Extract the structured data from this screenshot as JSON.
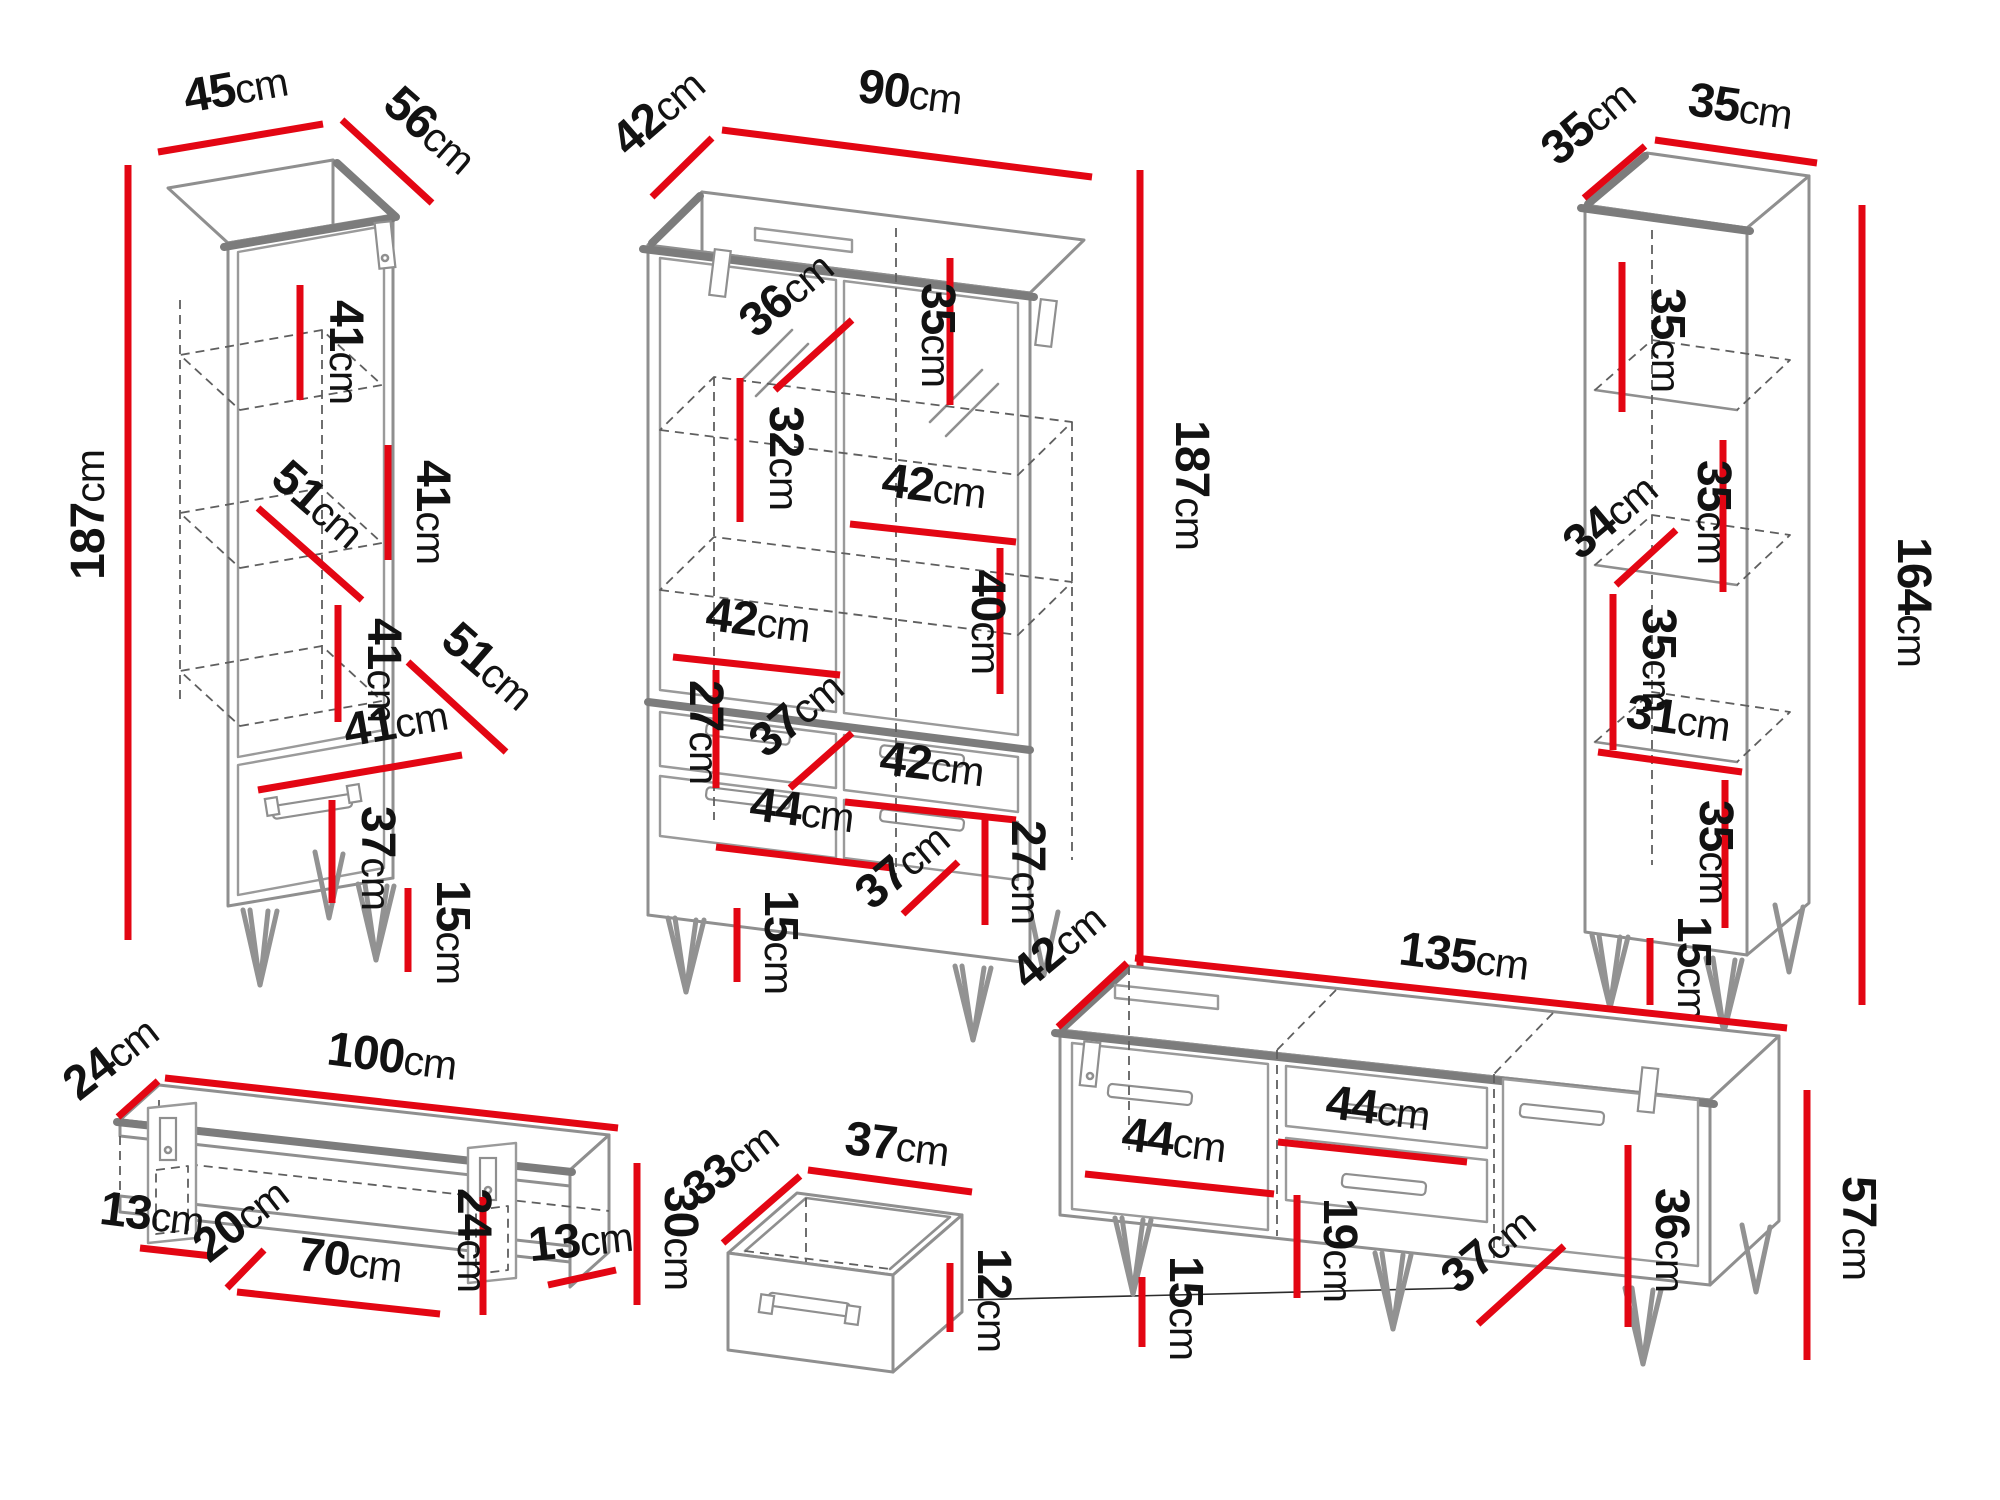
{
  "diagram_title": "Furniture set dimension diagram",
  "colors": {
    "dimension_line": "#e30613",
    "outline": "#8f8f8f",
    "label_text": "#121212",
    "background": "#ffffff"
  },
  "pieces": {
    "tall_cabinet": {
      "dims": {
        "width": {
          "v": "45",
          "u": "cm"
        },
        "depth": {
          "v": "56",
          "u": "cm"
        },
        "height": {
          "v": "187",
          "u": "cm"
        },
        "comp1": {
          "v": "41",
          "u": "cm"
        },
        "comp2": {
          "v": "41",
          "u": "cm"
        },
        "shelf_diag1": {
          "v": "51",
          "u": "cm"
        },
        "comp3": {
          "v": "41",
          "u": "cm"
        },
        "shelf_diag2": {
          "v": "51",
          "u": "cm"
        },
        "inner_width": {
          "v": "41",
          "u": "cm"
        },
        "drawer": {
          "v": "37",
          "u": "cm"
        },
        "legs": {
          "v": "15",
          "u": "cm"
        }
      }
    },
    "display_cabinet": {
      "dims": {
        "depth": {
          "v": "42",
          "u": "cm"
        },
        "width": {
          "v": "90",
          "u": "cm"
        },
        "height": {
          "v": "187",
          "u": "cm"
        },
        "glass_shelf": {
          "v": "36",
          "u": "cm"
        },
        "shelf_right": {
          "v": "35",
          "u": "cm"
        },
        "shelf_left": {
          "v": "32",
          "u": "cm"
        },
        "inner_right": {
          "v": "42",
          "u": "cm"
        },
        "door_height": {
          "v": "40",
          "u": "cm"
        },
        "inner_left": {
          "v": "42",
          "u": "cm"
        },
        "drawer_left": {
          "v": "27",
          "u": "cm"
        },
        "drawer_front": {
          "v": "37",
          "u": "cm"
        },
        "inner_lower": {
          "v": "42",
          "u": "cm"
        },
        "bottom_width": {
          "v": "44",
          "u": "cm"
        },
        "bottom_drawer": {
          "v": "37",
          "u": "cm"
        },
        "drawer_right": {
          "v": "27",
          "u": "cm"
        },
        "legs": {
          "v": "15",
          "u": "cm"
        }
      }
    },
    "shelf_unit": {
      "dims": {
        "depth": {
          "v": "35",
          "u": "cm"
        },
        "width": {
          "v": "35",
          "u": "cm"
        },
        "height": {
          "v": "164",
          "u": "cm"
        },
        "comp1": {
          "v": "35",
          "u": "cm"
        },
        "shelf_diag": {
          "v": "34",
          "u": "cm"
        },
        "comp2": {
          "v": "35",
          "u": "cm"
        },
        "comp3": {
          "v": "35",
          "u": "cm"
        },
        "inner_width": {
          "v": "31",
          "u": "cm"
        },
        "comp4": {
          "v": "35",
          "u": "cm"
        },
        "legs": {
          "v": "15",
          "u": "cm"
        }
      }
    },
    "wall_shelf": {
      "dims": {
        "depth": {
          "v": "24",
          "u": "cm"
        },
        "width": {
          "v": "100",
          "u": "cm"
        },
        "end_left": {
          "v": "13",
          "u": "cm"
        },
        "inner_depth": {
          "v": "20",
          "u": "cm"
        },
        "inner_width": {
          "v": "70",
          "u": "cm"
        },
        "inner_height": {
          "v": "24",
          "u": "cm"
        },
        "end_right": {
          "v": "13",
          "u": "cm"
        },
        "height": {
          "v": "30",
          "u": "cm"
        }
      }
    },
    "drawer_box": {
      "dims": {
        "depth": {
          "v": "33",
          "u": "cm"
        },
        "width": {
          "v": "37",
          "u": "cm"
        },
        "height": {
          "v": "12",
          "u": "cm"
        }
      }
    },
    "tv_stand": {
      "dims": {
        "depth": {
          "v": "42",
          "u": "cm"
        },
        "width": {
          "v": "135",
          "u": "cm"
        },
        "door_left": {
          "v": "44",
          "u": "cm"
        },
        "middle": {
          "v": "44",
          "u": "cm"
        },
        "drawer_height": {
          "v": "19",
          "u": "cm"
        },
        "legs": {
          "v": "15",
          "u": "cm"
        },
        "door_right": {
          "v": "37",
          "u": "cm"
        },
        "side_height": {
          "v": "36",
          "u": "cm"
        },
        "height": {
          "v": "57",
          "u": "cm"
        }
      }
    }
  }
}
